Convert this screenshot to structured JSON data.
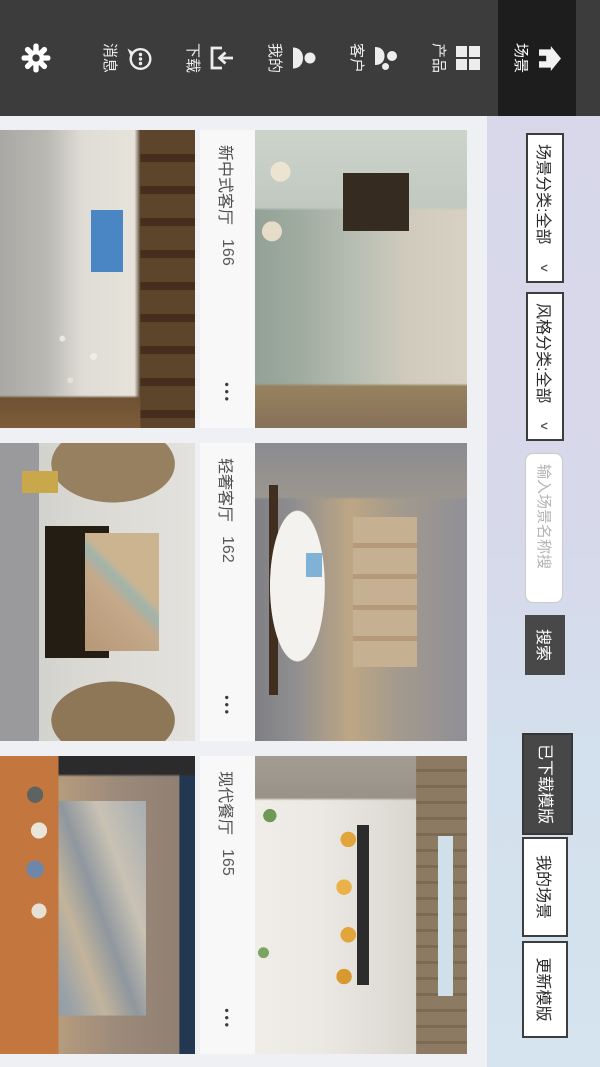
{
  "sidebar": {
    "items": [
      {
        "label": "场景",
        "icon": "home-icon",
        "active": true
      },
      {
        "label": "产品",
        "icon": "grid-icon",
        "active": false
      },
      {
        "label": "客户",
        "icon": "customer-icon",
        "active": false
      },
      {
        "label": "我的",
        "icon": "profile-icon",
        "active": false
      },
      {
        "label": "下载",
        "icon": "download-icon",
        "active": false
      },
      {
        "label": "消息",
        "icon": "message-icon",
        "active": false
      }
    ],
    "settings_icon": "gear-icon"
  },
  "filter_bar": {
    "scene_category_label": "场景分类:全部",
    "style_category_label": "风格分类:全部",
    "dropdown_chevron": "∨",
    "search_placeholder": "输入场景名称搜",
    "search_button_label": "搜索",
    "tab_downloaded": "已下载模版",
    "tab_my_scenes": "我的场景",
    "tab_update": "更新模版"
  },
  "cards": {
    "row1": [
      {
        "title": "新中式客厅",
        "count": "166",
        "menu_icon": "•••"
      },
      {
        "title": "轻奢客厅",
        "count": "162",
        "menu_icon": "•••"
      },
      {
        "title": "现代餐厅",
        "count": "165",
        "menu_icon": "•••"
      }
    ]
  },
  "colors": {
    "sidebar_bg": "#3c3c3c",
    "sidebar_active_bg": "#1d1d1d",
    "topbar_gradient_start": "#d9d8eb",
    "topbar_gradient_end": "#d5e4ee",
    "dark_button_bg": "#484848",
    "content_bg": "#eff0f3",
    "card_title_bg": "#f8f8f8"
  }
}
